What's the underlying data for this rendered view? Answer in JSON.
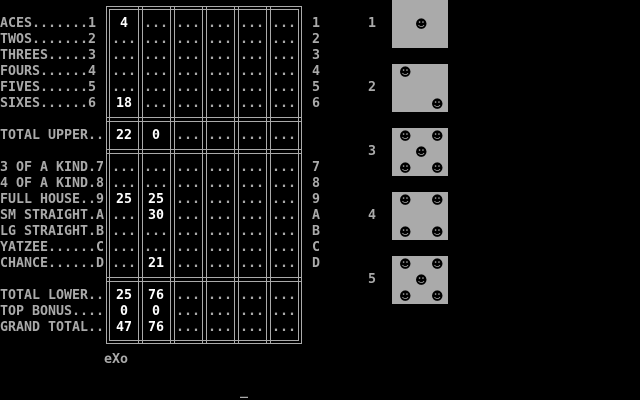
{
  "colors": {
    "background": "#000000",
    "foreground": "#aaaaaa",
    "highlight": "#ffffff",
    "die_face": "#aaaaaa",
    "die_pip": "#000000"
  },
  "scorecard": {
    "rows": [
      {
        "id": "aces",
        "row": 1,
        "label": "ACES.......1",
        "key": "1",
        "cells": [
          "4",
          "...",
          "...",
          "...",
          "...",
          "..."
        ]
      },
      {
        "id": "twos",
        "row": 2,
        "label": "TWOS.......2",
        "key": "2",
        "cells": [
          "...",
          "...",
          "...",
          "...",
          "...",
          "..."
        ]
      },
      {
        "id": "threes",
        "row": 3,
        "label": "THREES.....3",
        "key": "3",
        "cells": [
          "...",
          "...",
          "...",
          "...",
          "...",
          "..."
        ]
      },
      {
        "id": "fours",
        "row": 4,
        "label": "FOURS......4",
        "key": "4",
        "cells": [
          "...",
          "...",
          "...",
          "...",
          "...",
          "..."
        ]
      },
      {
        "id": "fives",
        "row": 5,
        "label": "FIVES......5",
        "key": "5",
        "cells": [
          "...",
          "...",
          "...",
          "...",
          "...",
          "..."
        ]
      },
      {
        "id": "sixes",
        "row": 6,
        "label": "SIXES......6",
        "key": "6",
        "cells": [
          "18",
          "...",
          "...",
          "...",
          "...",
          "..."
        ]
      },
      {
        "id": "total-upper",
        "row": 8,
        "label": "TOTAL UPPER..",
        "key": "",
        "cells": [
          "22",
          "0",
          "...",
          "...",
          "...",
          "..."
        ]
      },
      {
        "id": "three-of-a-kind",
        "row": 10,
        "label": "3 OF A KIND.7",
        "key": "7",
        "cells": [
          "...",
          "...",
          "...",
          "...",
          "...",
          "..."
        ]
      },
      {
        "id": "four-of-a-kind",
        "row": 11,
        "label": "4 OF A KIND.8",
        "key": "8",
        "cells": [
          "...",
          "...",
          "...",
          "...",
          "...",
          "..."
        ]
      },
      {
        "id": "full-house",
        "row": 12,
        "label": "FULL HOUSE..9",
        "key": "9",
        "cells": [
          "25",
          "25",
          "...",
          "...",
          "...",
          "..."
        ]
      },
      {
        "id": "sm-straight",
        "row": 13,
        "label": "SM STRAIGHT.A",
        "key": "A",
        "cells": [
          "...",
          "30",
          "...",
          "...",
          "...",
          "..."
        ]
      },
      {
        "id": "lg-straight",
        "row": 14,
        "label": "LG STRAIGHT.B",
        "key": "B",
        "cells": [
          "...",
          "...",
          "...",
          "...",
          "...",
          "..."
        ]
      },
      {
        "id": "yatzee",
        "row": 15,
        "label": "YATZEE......C",
        "key": "C",
        "cells": [
          "...",
          "...",
          "...",
          "...",
          "...",
          "..."
        ]
      },
      {
        "id": "chance",
        "row": 16,
        "label": "CHANCE......D",
        "key": "D",
        "cells": [
          "...",
          "21",
          "...",
          "...",
          "...",
          "..."
        ]
      },
      {
        "id": "total-lower",
        "row": 18,
        "label": "TOTAL LOWER..",
        "key": "",
        "cells": [
          "25",
          "76",
          "...",
          "...",
          "...",
          "..."
        ]
      },
      {
        "id": "top-bonus",
        "row": 19,
        "label": "TOP BONUS....",
        "key": "",
        "cells": [
          "0",
          "0",
          "...",
          "...",
          "...",
          "..."
        ]
      },
      {
        "id": "grand-total",
        "row": 20,
        "label": "GRAND TOTAL..",
        "key": "",
        "cells": [
          "47",
          "76",
          "...",
          "...",
          "...",
          "..."
        ]
      }
    ]
  },
  "dice": {
    "pip_glyph": "☻",
    "items": [
      {
        "label": "1",
        "value": 1
      },
      {
        "label": "2",
        "value": 2
      },
      {
        "label": "3",
        "value": 5
      },
      {
        "label": "4",
        "value": 4
      },
      {
        "label": "5",
        "value": 5
      }
    ]
  },
  "footer": {
    "tag": "eXo"
  },
  "prompt": {
    "text": "HOW MANY DICE TO ROLL AGAIN?",
    "cursor": "_"
  }
}
